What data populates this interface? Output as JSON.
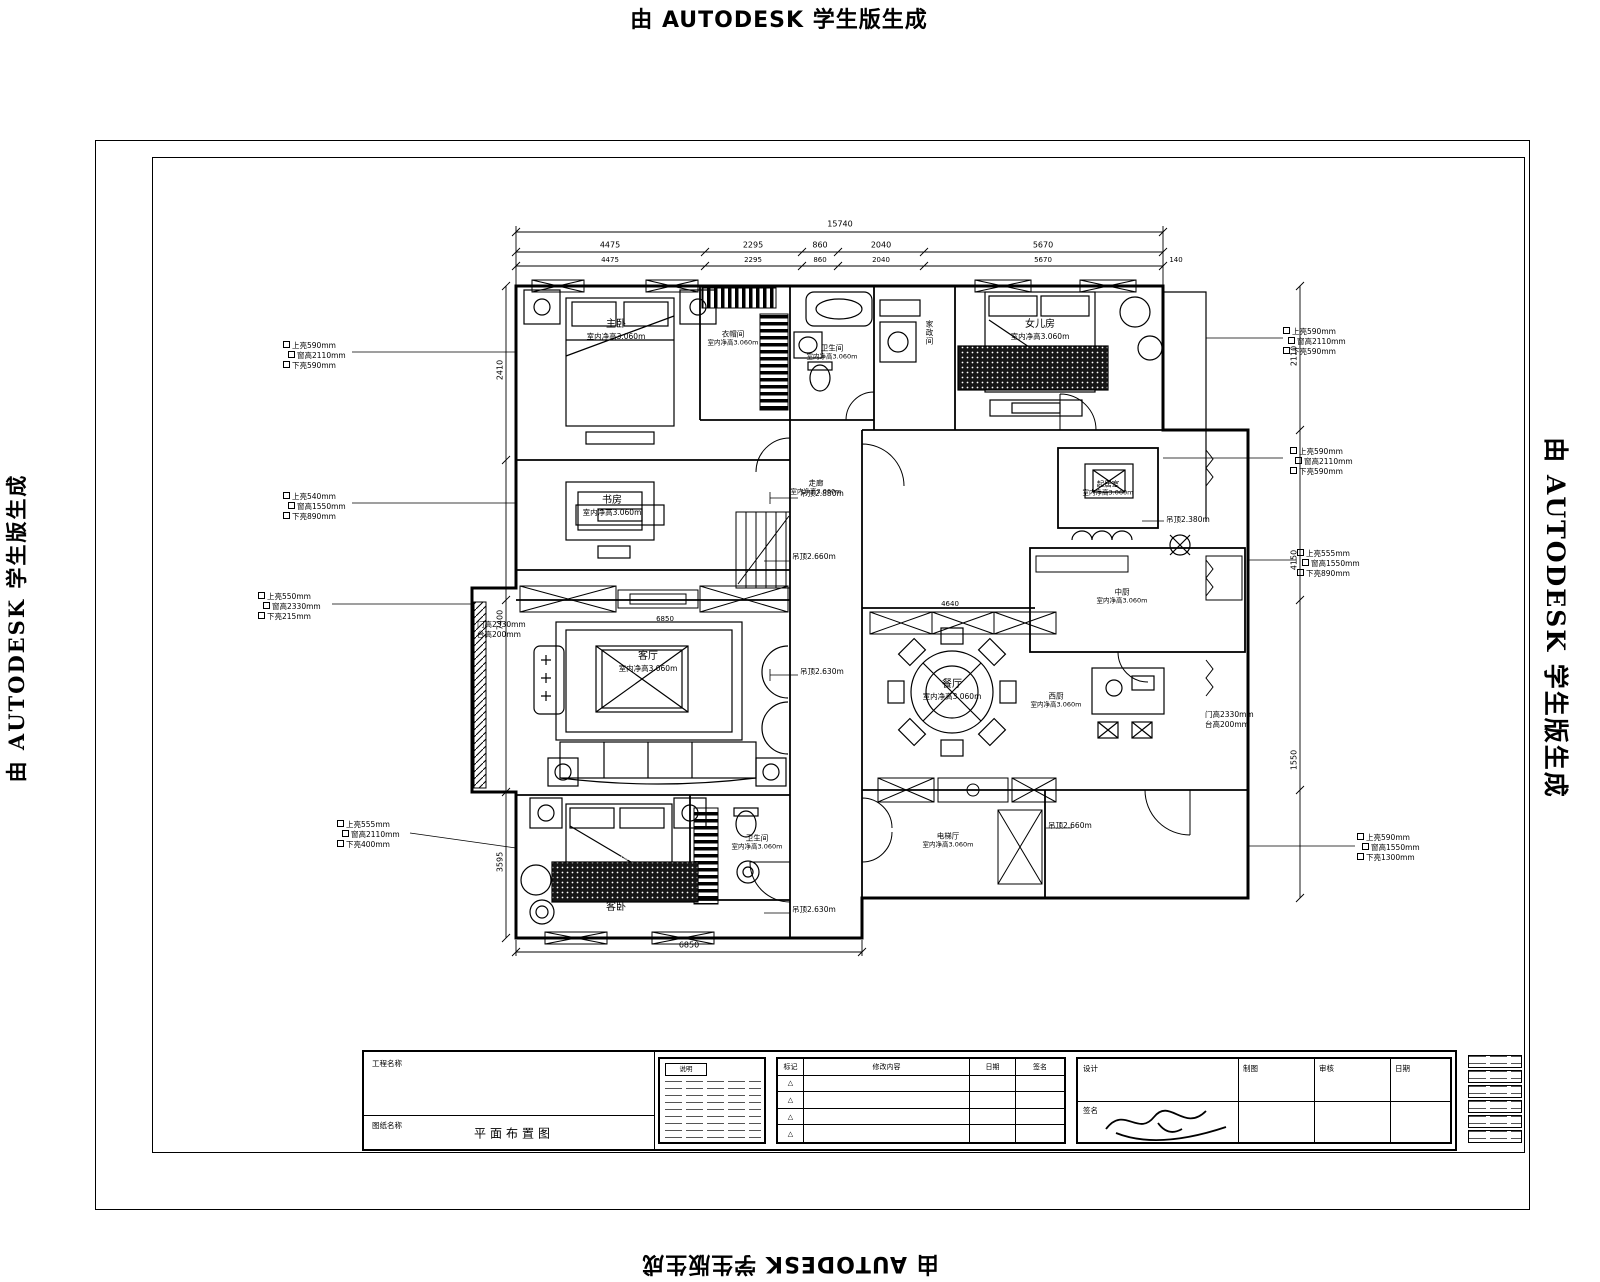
{
  "watermark": {
    "text": "由 AUTODESK 学生版生成"
  },
  "plan": {
    "rooms": [
      {
        "name": "主卧",
        "height": "室内净高3.060m"
      },
      {
        "name": "衣帽间",
        "height": "室内净高3.060m"
      },
      {
        "name": "卫生间",
        "height": "室内净高3.060m"
      },
      {
        "name": "家政间",
        "height": ""
      },
      {
        "name": "女儿房",
        "height": "室内净高3.060m"
      },
      {
        "name": "书房",
        "height": "室内净高3.060m"
      },
      {
        "name": "走廊",
        "height": "室内净高3.060m"
      },
      {
        "name": "起居室",
        "height": "室内净高3.060m"
      },
      {
        "name": "客厅",
        "height": "室内净高3.060m"
      },
      {
        "name": "餐厅",
        "height": "室内净高3.060m"
      },
      {
        "name": "中厨",
        "height": "室内净高3.060m"
      },
      {
        "name": "西厨",
        "height": "室内净高3.060m"
      },
      {
        "name": "电梯厅",
        "height": "室内净高3.060m"
      },
      {
        "name": "客卧",
        "height": "室内净高3.060m"
      },
      {
        "name": "卫生间",
        "height": "室内净高3.060m"
      }
    ],
    "ceilings": [
      "吊顶2.880m",
      "吊顶2.660m",
      "吊顶2.630m",
      "吊顶2.630m",
      "吊顶2.660m",
      "吊顶2.380m"
    ],
    "window_notes": [
      [
        "上亮590mm",
        "窗高2110mm",
        "下亮590mm"
      ],
      [
        "上亮540mm",
        "窗高1550mm",
        "下亮890mm"
      ],
      [
        "上亮550mm",
        "窗高2330mm",
        "下亮215mm"
      ],
      [
        "上亮555mm",
        "窗高2110mm",
        "下亮400mm"
      ],
      [
        "上亮590mm",
        "窗高2110mm",
        "下亮590mm"
      ],
      [
        "上亮590mm",
        "窗高2110mm",
        "下亮590mm"
      ],
      [
        "上亮555mm",
        "窗高1550mm",
        "下亮890mm"
      ],
      [
        "上亮590mm",
        "窗高1550mm",
        "下亮1300mm"
      ]
    ],
    "door_notes": [
      [
        "门高2330mm",
        "台高200mm"
      ],
      [
        "门高2330mm",
        "台高200mm"
      ]
    ],
    "dims": {
      "total": "15740",
      "segments": [
        "4475",
        "2295",
        "860",
        "2040",
        "5670"
      ],
      "end": "140",
      "bottom": "6850",
      "inner": [
        "4640",
        "6850"
      ],
      "left": [
        "2410",
        "7400",
        "3595"
      ],
      "right": [
        "2110",
        "4150",
        "1550"
      ]
    }
  },
  "titleblock": {
    "project_label": "工程名称",
    "drawing_label": "图纸名称",
    "drawing_name": "平面布置图",
    "note_label": "说明",
    "rev_headers": [
      "标记",
      "修改内容",
      "日期",
      "签名"
    ],
    "rev_mark": "△",
    "sign_labels": [
      "设计",
      "制图",
      "审核",
      "日期",
      "签名"
    ]
  }
}
